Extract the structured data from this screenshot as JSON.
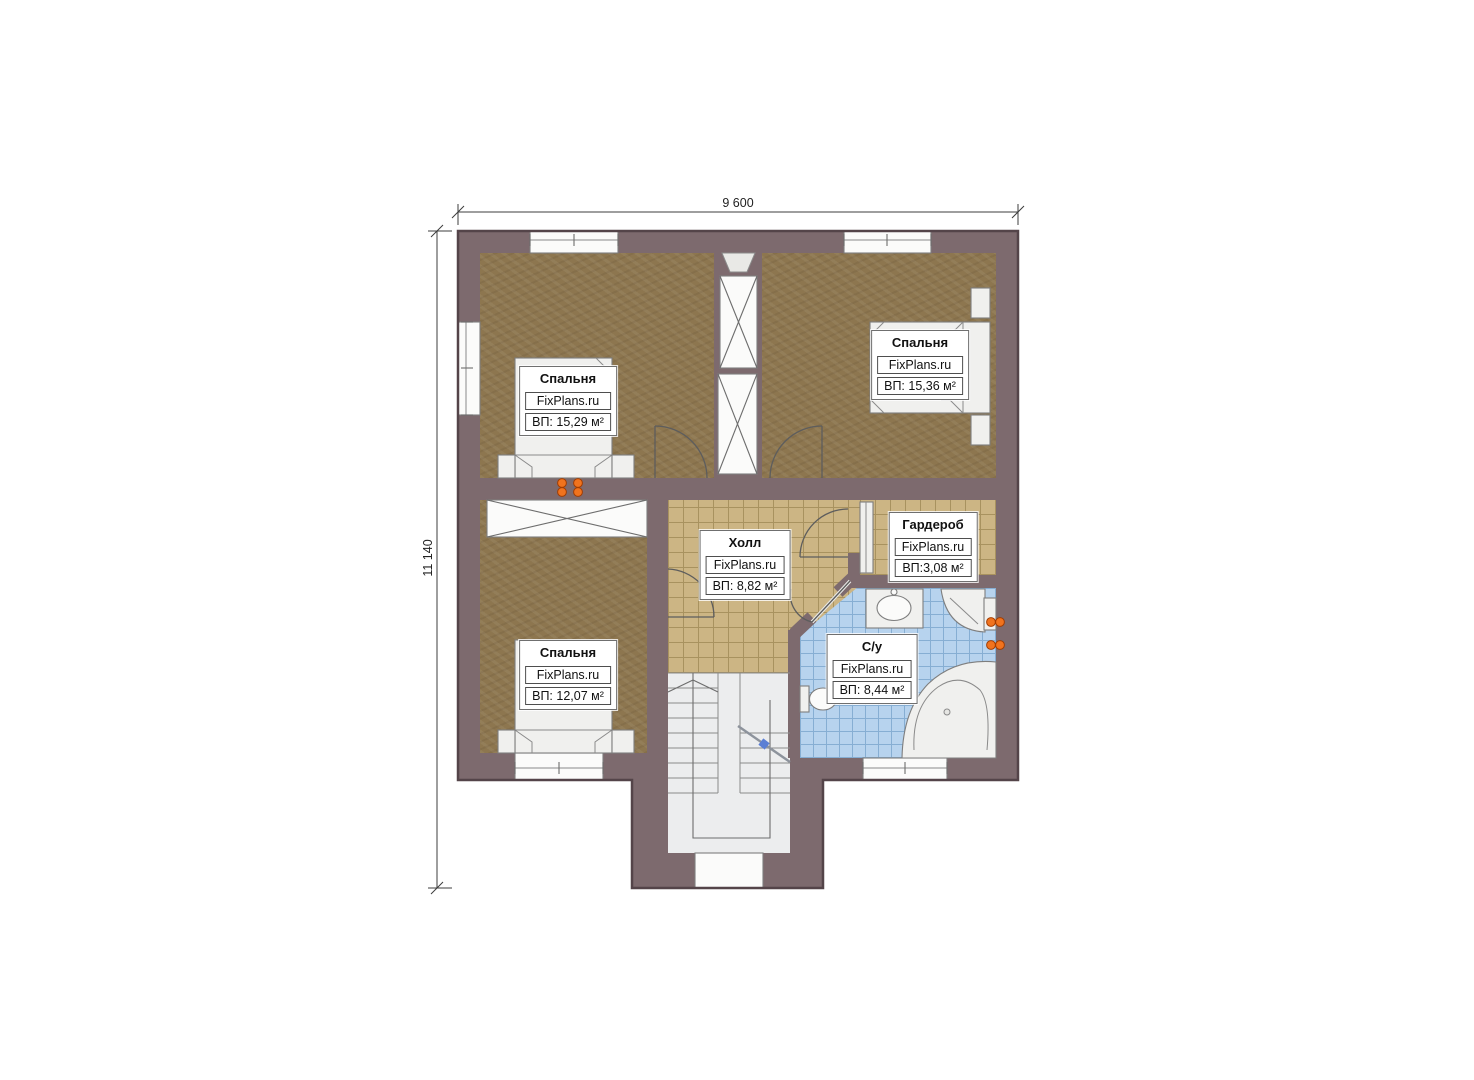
{
  "plan": {
    "type": "floor-plan",
    "branding": "FixPlans.ru",
    "dimensions": {
      "width": "9 600",
      "height": "11 140"
    },
    "rooms": [
      {
        "id": "bedroom-top-left",
        "name": "Спальня",
        "brand": "FixPlans.ru",
        "area": "ВП: 15,29 м²"
      },
      {
        "id": "bedroom-top-right",
        "name": "Спальня",
        "brand": "FixPlans.ru",
        "area": "ВП: 15,36 м²"
      },
      {
        "id": "bedroom-bottom-left",
        "name": "Спальня",
        "brand": "FixPlans.ru",
        "area": "ВП: 12,07 м²"
      },
      {
        "id": "hall",
        "name": "Холл",
        "brand": "FixPlans.ru",
        "area": "ВП: 8,82 м²"
      },
      {
        "id": "wardrobe",
        "name": "Гардероб",
        "brand": "FixPlans.ru",
        "area": "ВП:3,08 м²"
      },
      {
        "id": "bathroom",
        "name": "С/у",
        "brand": "FixPlans.ru",
        "area": "ВП: 8,44 м²"
      }
    ],
    "colors": {
      "wall": "#7d6a6e",
      "wall_outline": "#544449",
      "floor_bedroom": "#8d764f",
      "floor_hall": "#ccb584",
      "tile_line_tan": "#a8925f",
      "floor_bath": "#b7d3ee",
      "tile_line_blue": "#86aed3",
      "fixture": "#f0f0ee",
      "stair": "#ecedee",
      "socket": "#f1731e"
    }
  }
}
